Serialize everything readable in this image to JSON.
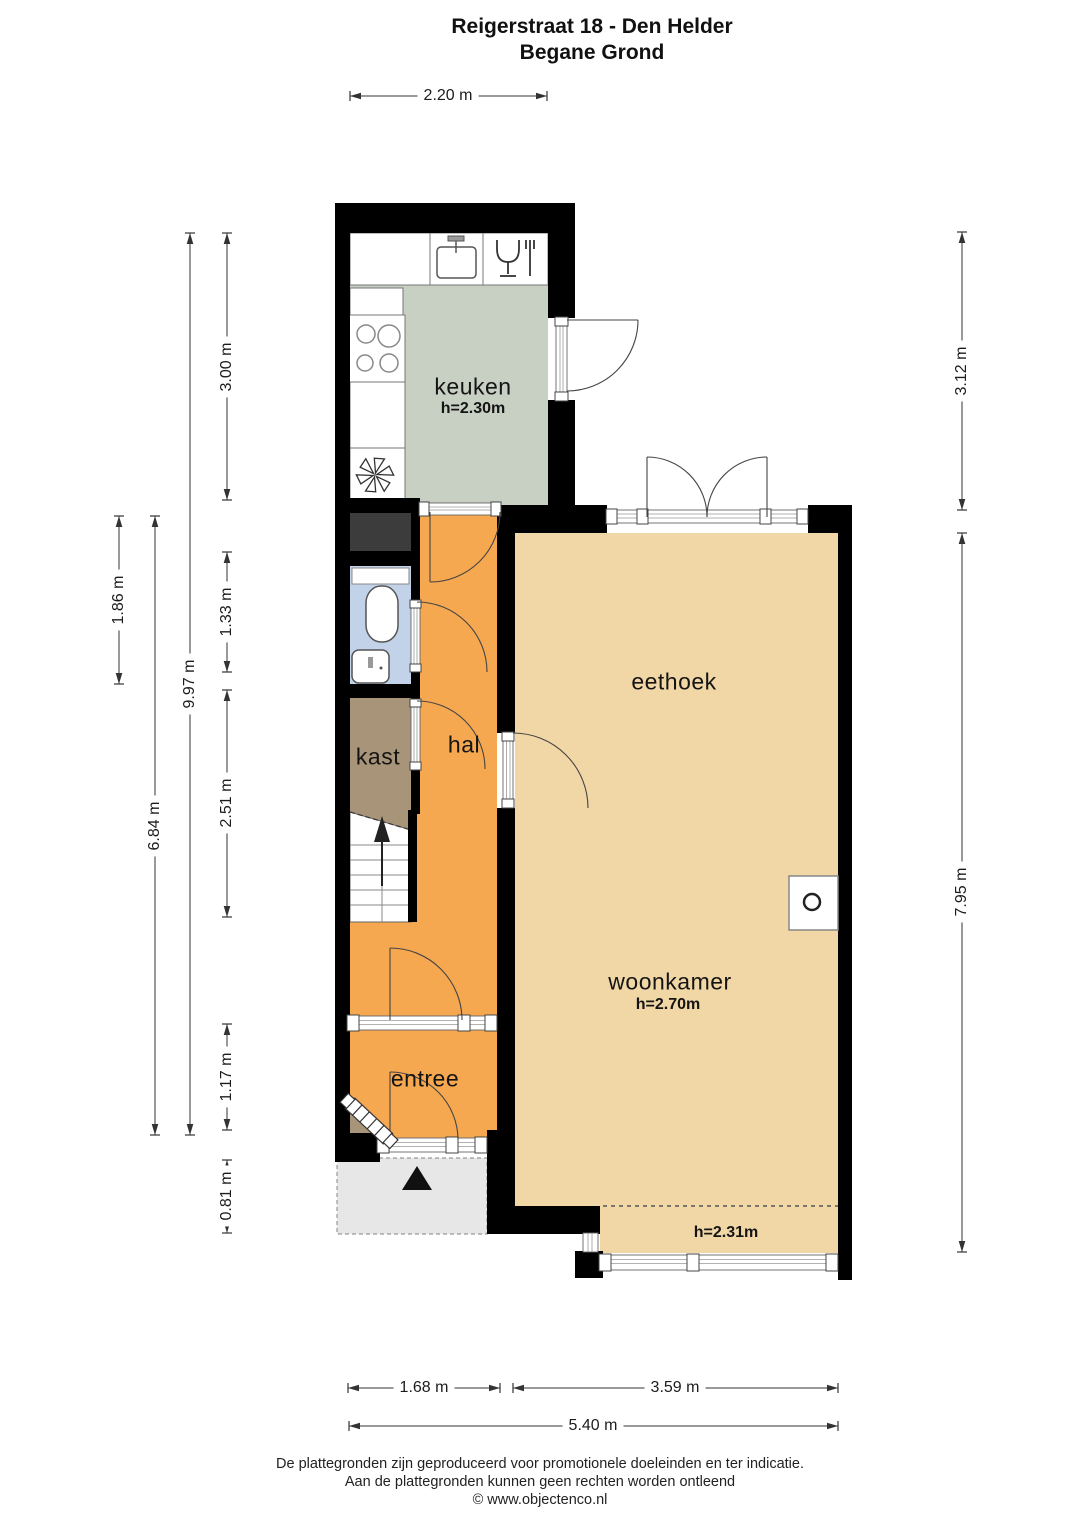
{
  "title": {
    "line1": "Reigerstraat 18 - Den Helder",
    "line2": "Begane Grond"
  },
  "rooms": {
    "keuken": {
      "label": "keuken",
      "height": "h=2.30m"
    },
    "eethoek": {
      "label": "eethoek"
    },
    "hal": {
      "label": "hal"
    },
    "kast": {
      "label": "kast"
    },
    "woonkamer": {
      "label": "woonkamer",
      "height": "h=2.70m"
    },
    "entree": {
      "label": "entree"
    },
    "uitbouw": {
      "height": "h=2.31m"
    }
  },
  "dimensions": {
    "top_width": "2.20 m",
    "left_toilet_block": "1.86 m",
    "left_lower": "6.84 m",
    "left_total": "9.97 m",
    "left_kitchen": "3.00 m",
    "left_toilet": "1.33 m",
    "left_hall": "2.51 m",
    "left_entree": "1.17 m",
    "left_porch": "0.81 m",
    "right_upper": "3.12 m",
    "right_living": "7.95 m",
    "bottom_hall": "1.68 m",
    "bottom_living": "3.59 m",
    "bottom_total": "5.40 m"
  },
  "footer": {
    "line1": "De plattegronden zijn geproduceerd voor promotionele doeleinden en ter indicatie.",
    "line2": "Aan de plattegronden kunnen geen rechten worden ontleend",
    "line3": "© www.objectenco.nl"
  },
  "colors": {
    "wall": "#000000",
    "kitchen_floor": "#c8cfc3",
    "hall_floor": "#f6a850",
    "living_floor": "#f2d7a6",
    "toilet_floor": "#c2d3e9",
    "closet_floor": "#a89478",
    "porch_floor": "#e7e7e7",
    "shaft_fill": "#3c3c3c",
    "line": "#333333"
  },
  "icons": [
    "sink-icon",
    "dishwasher-icon",
    "stove-icon",
    "ventilation-fan-icon",
    "toilet-icon",
    "hand-basin-icon",
    "stairs-up-arrow-icon",
    "fireplace-stove-icon",
    "meter-cupboard-radiator-icon",
    "entrance-arrow-icon",
    "door-swing-icon",
    "window-icon"
  ]
}
